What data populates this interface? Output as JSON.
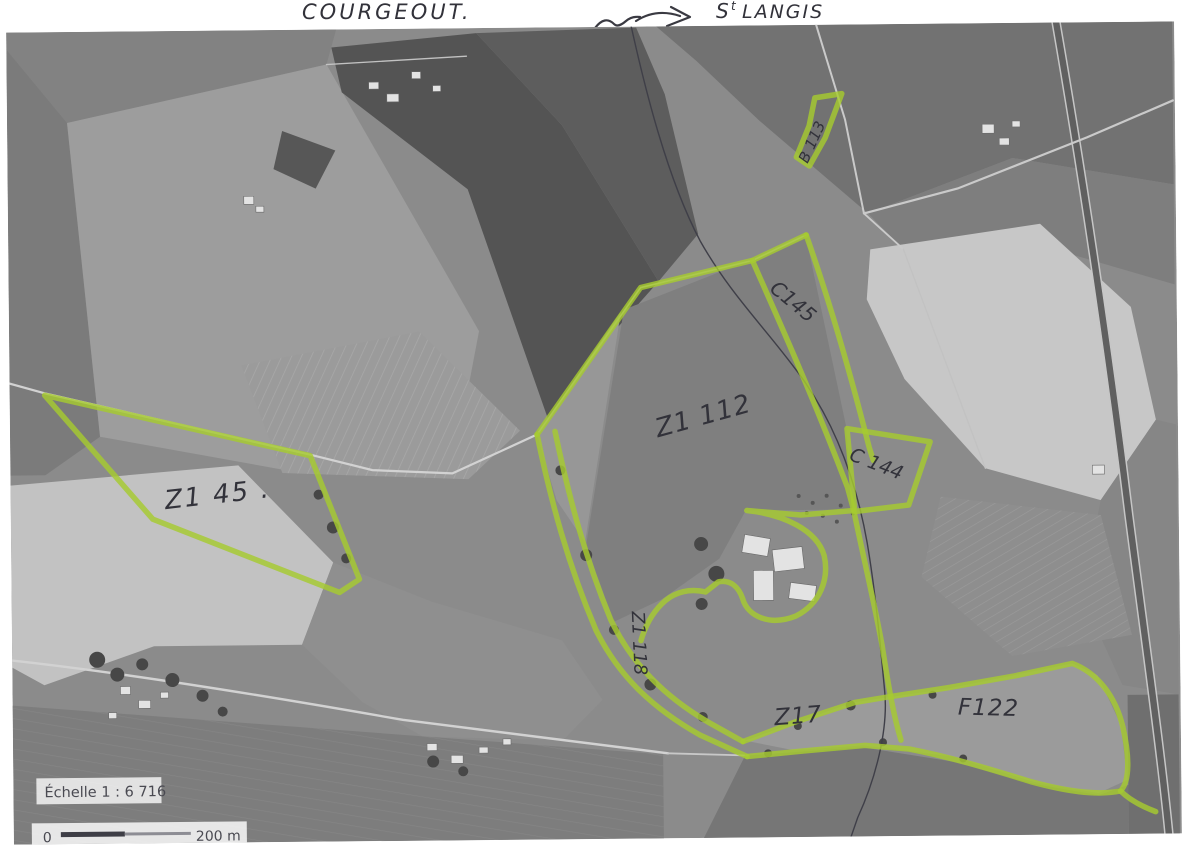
{
  "header": {
    "place_left": "COURGEOUT.",
    "arrow_icon": "squiggle-route-arrow",
    "place_right_initial": "S",
    "place_right_sup": "t",
    "place_right_rest": "LANGIS"
  },
  "map": {
    "kind": "scanned aerial photo with cadastral parcels highlighted in green marker",
    "highlight_color": "#a6ca30",
    "parcel_labels": [
      {
        "text": "Z1 45 .",
        "area": "west"
      },
      {
        "text": "Z1 112",
        "area": "center"
      },
      {
        "text": "C145",
        "area": "north-center",
        "orientation": "diagonal"
      },
      {
        "text": "C 144",
        "area": "east-center"
      },
      {
        "text": "Z1 118",
        "area": "center-south",
        "orientation": "vertical"
      },
      {
        "text": "Z17",
        "area": "south"
      },
      {
        "text": "F122",
        "area": "south-east"
      },
      {
        "text": "B 113",
        "area": "north-east",
        "orientation": "vertical"
      }
    ],
    "scale_panel": {
      "label": "Échelle 1 : 6 716"
    },
    "scale_bar": {
      "start": "0",
      "end": "200 m"
    }
  }
}
